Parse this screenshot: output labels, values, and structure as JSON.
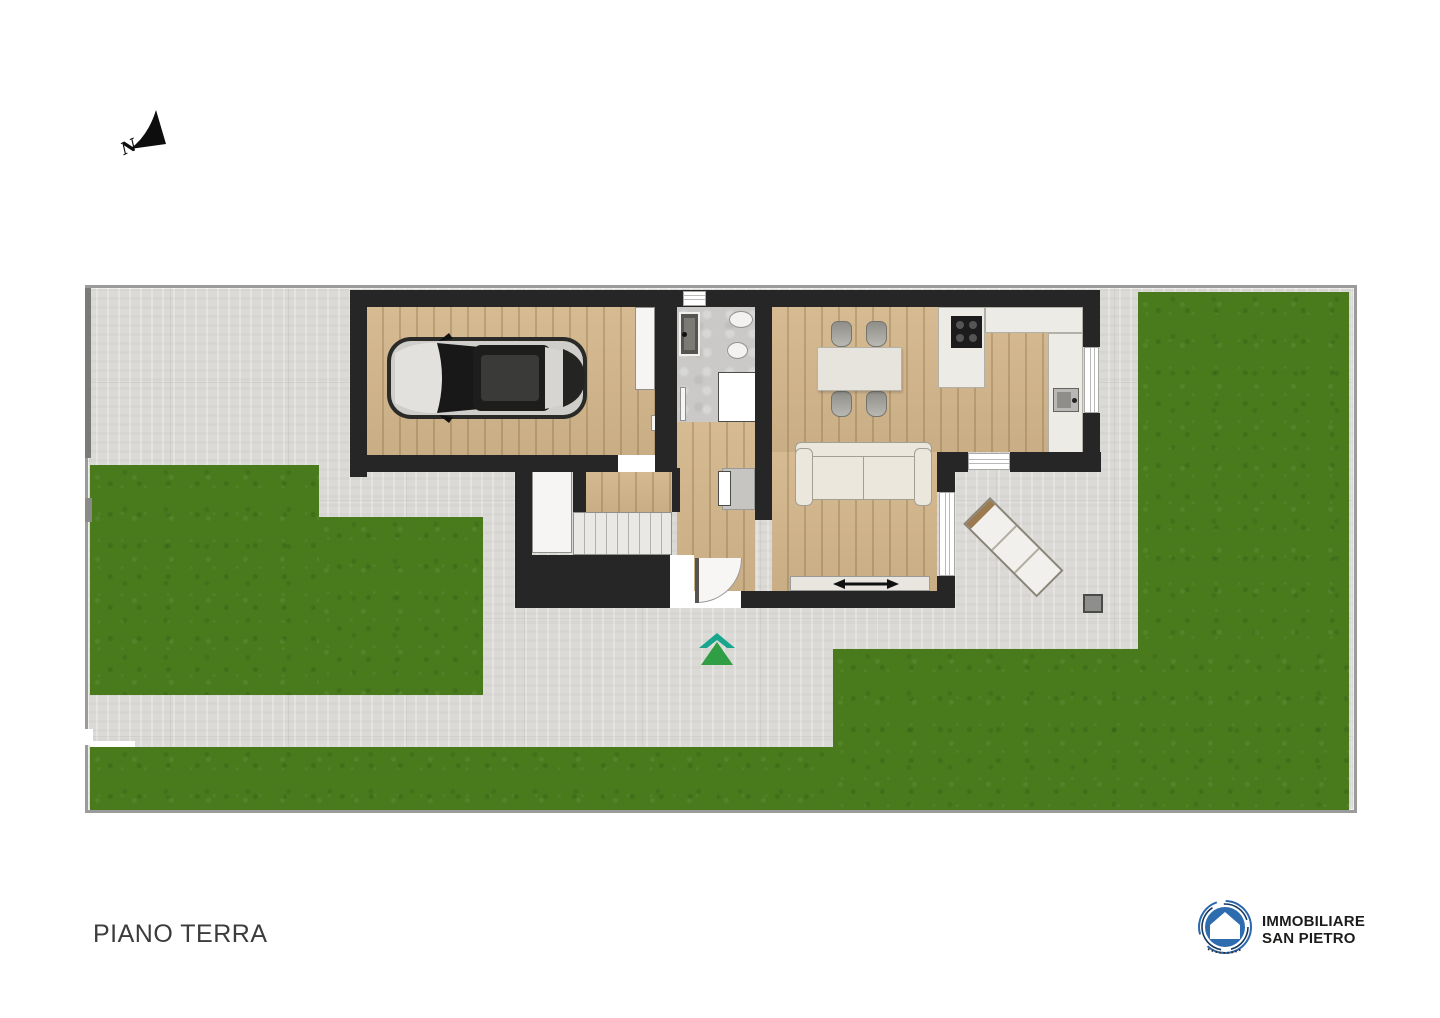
{
  "title": "PIANO TERRA",
  "compass": {
    "label": "N",
    "icon": "north-arrow-icon"
  },
  "logo": {
    "line1": "IMMOBILIARE",
    "line2": "SAN PIETRO",
    "icon": "house-in-circle-logo"
  },
  "markers": {
    "entrance": "double-chevron-up-arrow",
    "sliding_door": "double-headed-arrow"
  },
  "colors": {
    "grass": "#497b1d",
    "pavement": "#dbdad7",
    "wall": "#262626",
    "wood_floor": "#d4b78c",
    "bathroom_tile": "#cac9c7",
    "entrance_arrow_green": "#2f9e44",
    "entrance_arrow_teal": "#18a68e",
    "logo_blue": "#2e6cb0",
    "plot_border": "#9b9b9b"
  }
}
